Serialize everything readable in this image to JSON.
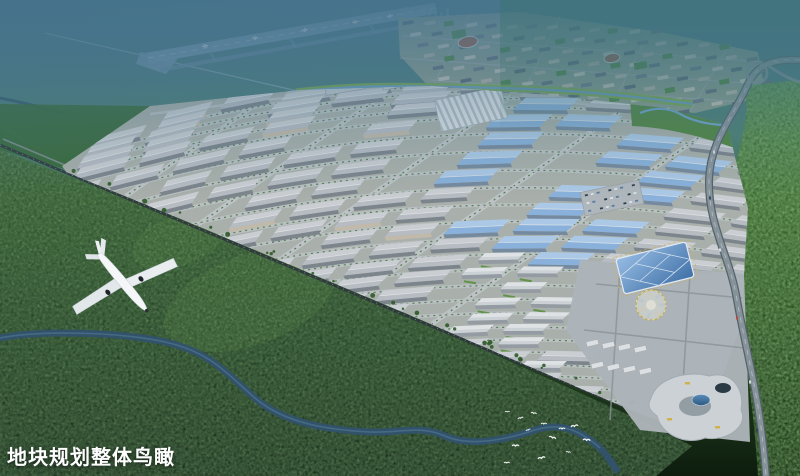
{
  "caption": {
    "text": "地块规划整体鸟瞰"
  },
  "scene": {
    "colors": {
      "haze": "#4a7690",
      "forest_dark": "#14290f",
      "forest_light": "#4c7f38",
      "runway": "#7e9fba",
      "warehouse_roof_light": "#d3d5d8",
      "warehouse_roof_dark": "#bfc2c8",
      "blue_roof_light": "#b3d0ee",
      "blue_roof_dark": "#8fb7e2",
      "road": "#c3c7c9",
      "river": "#33536e",
      "highway": "#8d979e",
      "canal_water": "#74a9d2",
      "accent_yellow": "#d8b84a",
      "caption_text": "#ffffff"
    },
    "elements": [
      "airport-runway",
      "residential-district",
      "industrial-park",
      "warehouse-grid",
      "blue-roof-halls",
      "incubator-blocks",
      "commercial-center",
      "convention-center",
      "circular-plaza",
      "shopping-mall",
      "landscape-pond",
      "forest",
      "river",
      "railway",
      "highway",
      "airplane",
      "egret-flock"
    ]
  }
}
